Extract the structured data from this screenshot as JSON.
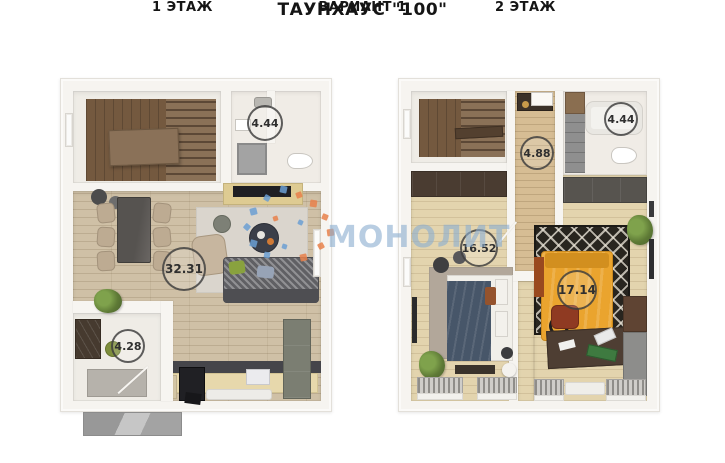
{
  "header": {
    "title": "ТАУНХАУС \"100\"",
    "subtitle": "ВАРИАНТ 1"
  },
  "floor1": {
    "label": "1 ЭТАЖ",
    "areas": {
      "bathroom": "4.44",
      "living_kitchen": "32.31",
      "hallway": "4.28"
    }
  },
  "floor2": {
    "label": "2 ЭТАЖ",
    "areas": {
      "hall": "4.88",
      "bathroom": "4.44",
      "bedroom_left": "16.52",
      "bedroom_right": "17.14"
    }
  },
  "watermark": {
    "text": "МОНОЛИТ",
    "color_blue": "#6b9fd2",
    "color_orange": "#e8804a"
  }
}
